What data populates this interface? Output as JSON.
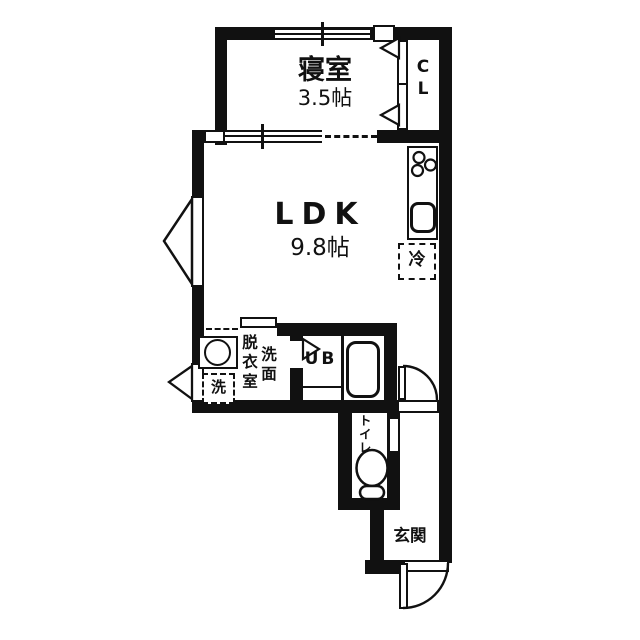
{
  "rooms": {
    "bedroom": {
      "name": "寝室",
      "size": "3.5帖"
    },
    "closet": {
      "letters": [
        "C",
        "L"
      ]
    },
    "ldk": {
      "name": "LDK",
      "size": "9.8帖"
    },
    "bath": {
      "name": "UB"
    },
    "toilet": {
      "name": "トイレ"
    },
    "entrance": {
      "name": "玄関"
    },
    "washroom": {
      "dressing": "脱衣室",
      "basin": "洗面"
    }
  },
  "fixtures": {
    "fridge": "冷",
    "washer": "洗"
  },
  "colors": {
    "wall": "#111111",
    "background": "#ffffff"
  }
}
